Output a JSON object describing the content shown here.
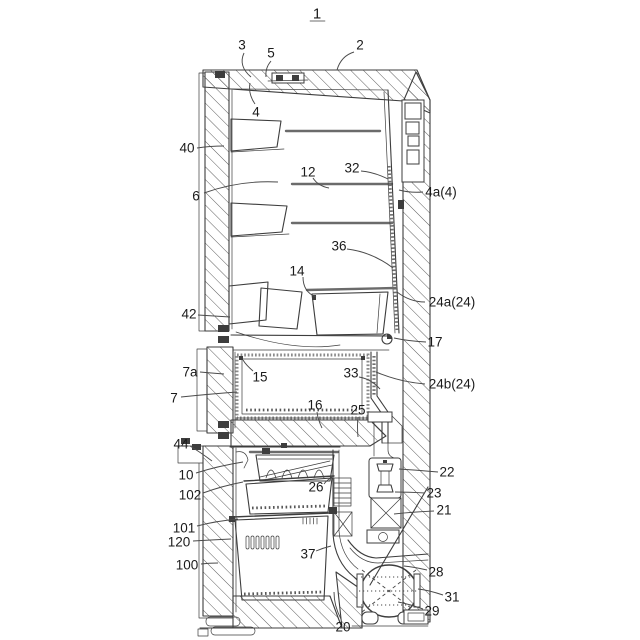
{
  "figure": {
    "figure_number": "1",
    "labels": [
      {
        "text": "3",
        "x": 242,
        "y": 45,
        "leader": {
          "sx": 244,
          "sy": 53,
          "cx": 238,
          "cy": 66,
          "ex": 251,
          "ey": 77
        }
      },
      {
        "text": "5",
        "x": 271,
        "y": 53,
        "leader": {
          "sx": 271,
          "sy": 61,
          "cx": 265,
          "cy": 68,
          "ex": 266,
          "ey": 77
        }
      },
      {
        "text": "2",
        "x": 360,
        "y": 45,
        "leader": {
          "sx": 354,
          "sy": 52,
          "cx": 341,
          "cy": 56,
          "ex": 337,
          "ey": 70
        }
      },
      {
        "text": "4",
        "x": 256,
        "y": 112,
        "leader": {
          "sx": 255,
          "sy": 104,
          "cx": 248,
          "cy": 94,
          "ex": 250,
          "ey": 83
        }
      },
      {
        "text": "40",
        "x": 187,
        "y": 148,
        "leader": {
          "sx": 197,
          "sy": 148,
          "cx": 210,
          "cy": 146,
          "ex": 224,
          "ey": 146
        }
      },
      {
        "text": "6",
        "x": 196,
        "y": 196,
        "leader": {
          "sx": 204,
          "sy": 193,
          "cx": 240,
          "cy": 180,
          "ex": 278,
          "ey": 182
        }
      },
      {
        "text": "12",
        "x": 308,
        "y": 172,
        "leader": {
          "sx": 313,
          "sy": 178,
          "cx": 318,
          "cy": 186,
          "ex": 329,
          "ey": 188
        }
      },
      {
        "text": "32",
        "x": 352,
        "y": 168,
        "leader": {
          "sx": 361,
          "sy": 171,
          "cx": 374,
          "cy": 172,
          "ex": 388,
          "ey": 179
        }
      },
      {
        "text": "4a(4)",
        "x": 441,
        "y": 192,
        "leader": {
          "sx": 423,
          "sy": 192,
          "cx": 410,
          "cy": 193,
          "ex": 399,
          "ey": 190
        }
      },
      {
        "text": "36",
        "x": 339,
        "y": 246,
        "leader": {
          "sx": 347,
          "sy": 249,
          "cx": 372,
          "cy": 252,
          "ex": 393,
          "ey": 268
        }
      },
      {
        "text": "14",
        "x": 297,
        "y": 271,
        "leader": {
          "sx": 303,
          "sy": 277,
          "cx": 303,
          "cy": 292,
          "ex": 316,
          "ey": 297
        }
      },
      {
        "text": "24a(24)",
        "x": 452,
        "y": 302,
        "leader": {
          "sx": 425,
          "sy": 302,
          "cx": 410,
          "cy": 302,
          "ex": 397,
          "ey": 292
        }
      },
      {
        "text": "42",
        "x": 189,
        "y": 314,
        "leader": {
          "sx": 198,
          "sy": 315,
          "cx": 214,
          "cy": 316,
          "ex": 230,
          "ey": 317
        }
      },
      {
        "text": "17",
        "x": 435,
        "y": 342,
        "leader": {
          "sx": 426,
          "sy": 342,
          "cx": 408,
          "cy": 341,
          "ex": 394,
          "ey": 338
        }
      },
      {
        "text": "7a",
        "x": 190,
        "y": 372,
        "leader": {
          "sx": 200,
          "sy": 372,
          "cx": 211,
          "cy": 373,
          "ex": 224,
          "ey": 374
        }
      },
      {
        "text": "15",
        "x": 260,
        "y": 377,
        "leader": {
          "sx": 253,
          "sy": 371,
          "cx": 246,
          "cy": 365,
          "ex": 243,
          "ey": 360
        }
      },
      {
        "text": "33",
        "x": 351,
        "y": 373,
        "leader": {
          "sx": 359,
          "sy": 377,
          "cx": 371,
          "cy": 379,
          "ex": 380,
          "ey": 389
        }
      },
      {
        "text": "24b(24)",
        "x": 452,
        "y": 384,
        "leader": {
          "sx": 425,
          "sy": 384,
          "cx": 400,
          "cy": 382,
          "ex": 376,
          "ey": 372
        }
      },
      {
        "text": "7",
        "x": 174,
        "y": 398,
        "leader": {
          "sx": 181,
          "sy": 397,
          "cx": 210,
          "cy": 394,
          "ex": 237,
          "ey": 392
        }
      },
      {
        "text": "16",
        "x": 315,
        "y": 405,
        "leader": {
          "sx": 317,
          "sy": 412,
          "cx": 318,
          "cy": 420,
          "ex": 322,
          "ey": 428
        }
      },
      {
        "text": "25",
        "x": 358,
        "y": 410,
        "leader": {
          "sx": 358,
          "sy": 417,
          "cx": 357,
          "cy": 426,
          "ex": 358,
          "ey": 437
        }
      },
      {
        "text": "44",
        "x": 181,
        "y": 444,
        "leader": {
          "sx": 190,
          "sy": 446,
          "cx": 200,
          "cy": 452,
          "ex": 212,
          "ey": 461
        }
      },
      {
        "text": "10",
        "x": 186,
        "y": 475,
        "leader": {
          "sx": 196,
          "sy": 473,
          "cx": 218,
          "cy": 466,
          "ex": 243,
          "ey": 462
        }
      },
      {
        "text": "22",
        "x": 447,
        "y": 472,
        "leader": {
          "sx": 438,
          "sy": 472,
          "cx": 416,
          "cy": 470,
          "ex": 399,
          "ey": 469
        }
      },
      {
        "text": "102",
        "x": 190,
        "y": 495,
        "leader": {
          "sx": 203,
          "sy": 493,
          "cx": 222,
          "cy": 486,
          "ex": 243,
          "ey": 482
        }
      },
      {
        "text": "26",
        "x": 316,
        "y": 487,
        "leader": {
          "sx": 324,
          "sy": 484,
          "cx": 327,
          "cy": 480,
          "ex": 332,
          "ey": 477
        }
      },
      {
        "text": "23",
        "x": 434,
        "y": 493,
        "leader": {
          "sx": 425,
          "sy": 493,
          "cx": 408,
          "cy": 492,
          "ex": 395,
          "ey": 492
        }
      },
      {
        "text": "21",
        "x": 444,
        "y": 510,
        "leader": {
          "sx": 434,
          "sy": 511,
          "cx": 412,
          "cy": 512,
          "ex": 394,
          "ey": 514
        }
      },
      {
        "text": "101",
        "x": 184,
        "y": 528,
        "leader": {
          "sx": 197,
          "sy": 526,
          "cx": 216,
          "cy": 521,
          "ex": 238,
          "ey": 519
        }
      },
      {
        "text": "120",
        "x": 179,
        "y": 542,
        "leader": {
          "sx": 193,
          "sy": 541,
          "cx": 210,
          "cy": 540,
          "ex": 231,
          "ey": 539
        }
      },
      {
        "text": "100",
        "x": 187,
        "y": 565,
        "leader": {
          "sx": 201,
          "sy": 564,
          "cx": 209,
          "cy": 563,
          "ex": 218,
          "ey": 563
        }
      },
      {
        "text": "37",
        "x": 308,
        "y": 554,
        "leader": {
          "sx": 316,
          "sy": 551,
          "cx": 323,
          "cy": 548,
          "ex": 331,
          "ey": 546
        }
      },
      {
        "text": "28",
        "x": 436,
        "y": 572,
        "leader": {
          "sx": 427,
          "sy": 570,
          "cx": 414,
          "cy": 567,
          "ex": 404,
          "ey": 566
        }
      },
      {
        "text": "31",
        "x": 452,
        "y": 597,
        "leader": {
          "sx": 443,
          "sy": 595,
          "cx": 428,
          "cy": 590,
          "ex": 418,
          "ey": 589
        }
      },
      {
        "text": "29",
        "x": 432,
        "y": 611,
        "leader": {
          "sx": 423,
          "sy": 609,
          "cx": 409,
          "cy": 604,
          "ex": 398,
          "ey": 602
        }
      },
      {
        "text": "20",
        "x": 343,
        "y": 627,
        "leader": {
          "sx": 341,
          "sy": 619,
          "cx": 334,
          "cy": 606,
          "ex": 334,
          "ey": 592
        }
      }
    ]
  },
  "colors": {
    "background": "#ffffff",
    "line": "#3d3d3d",
    "label_text": "#1b1b1b",
    "hatch": "#5f5f5f"
  }
}
